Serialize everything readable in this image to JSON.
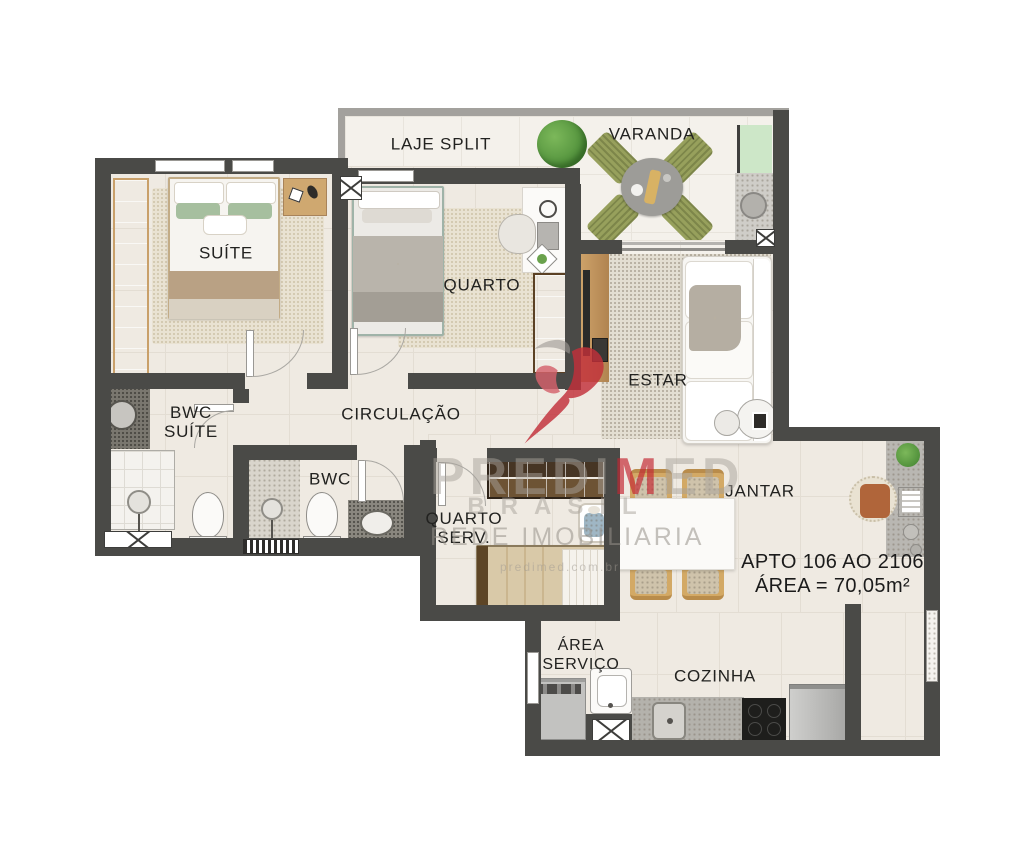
{
  "meta": {
    "apto_line1": "APTO 106 AO 2106",
    "apto_line2": "ÁREA = 70,05m²"
  },
  "rooms": {
    "laje": {
      "label": "LAJE SPLIT"
    },
    "varanda": {
      "label": "VARANDA"
    },
    "suite": {
      "label": "SUÍTE"
    },
    "quarto": {
      "label": "QUARTO"
    },
    "estar": {
      "label": "ESTAR"
    },
    "bwc_suite": {
      "label": "BWC\nSUÍTE"
    },
    "circulacao": {
      "label": "CIRCULAÇÃO"
    },
    "bwc": {
      "label": "BWC"
    },
    "quarto_serv": {
      "label": "QUARTO\nSERV."
    },
    "jantar": {
      "label": "JANTAR"
    },
    "area_servico": {
      "label": "ÁREA\nSERVIÇO"
    },
    "cozinha": {
      "label": "COZINHA"
    }
  },
  "watermark": {
    "brand_pre": "PREDI",
    "brand_accent": "M",
    "brand_post": "ED",
    "brand_sub": "BRASIL",
    "network": "REDE IMOBILIARIA",
    "site": "predimed.com.br"
  },
  "colors": {
    "wall": "#4a4a47",
    "floor": "#efeae2",
    "accent_red": "#c2303a",
    "wood": "#8a6038",
    "green_mat": "#cde7c8",
    "olive_chair": "#97a05c"
  }
}
